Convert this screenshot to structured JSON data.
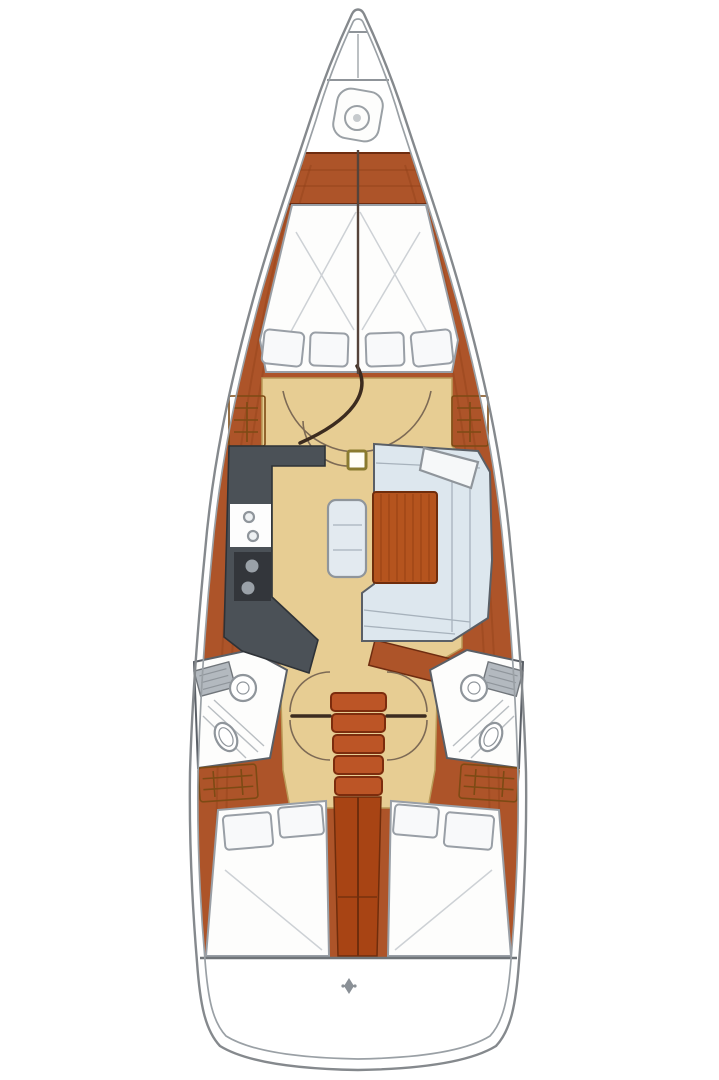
{
  "diagram": {
    "kind": "sailboat-interior-floor-plan",
    "orientation": "bow-up",
    "areas": {
      "bow": [
        "anchor-windlass"
      ],
      "forward_cabin": [
        "v-berth",
        "berth-center-split",
        "pillows-x4",
        "hanging-locker-port",
        "hanging-locker-starboard",
        "cabin-door-swing"
      ],
      "galley_port": [
        "counter",
        "double-sink",
        "two-burner-stove"
      ],
      "salon_starboard": [
        "u-shaped-settee",
        "wood-table",
        "center-bench",
        "corner-shelf",
        "mast-step"
      ],
      "heads": [
        "port-head-with-toilet-sink-shower",
        "starboard-head-with-toilet-sink-shower"
      ],
      "companionway": [
        "five-step-ladder",
        "engine-compartment"
      ],
      "aft_cabins": [
        "port-double-berth-2-pillows",
        "starboard-double-berth-2-pillows",
        "aft-locker-port",
        "aft-locker-starboard"
      ],
      "stern": [
        "cockpit-sole-line",
        "transom-marker"
      ]
    },
    "pillow_count_forward": 4,
    "pillow_count_aft_per_cabin": 2,
    "ladder_steps": 5
  },
  "colors": {
    "hull_fill": "#ffffff",
    "wood": "#ad5429",
    "floor": "#e7cd93",
    "counter": "#4b5157",
    "stove": "#33363b",
    "burner": "#9aa1a8",
    "sink_white": "#fdfdfd",
    "upholstery": "#dde7ee",
    "bench": "#e3eaf0",
    "table": "#b5541e",
    "ladder": "#bc5526",
    "engine": "#a84414",
    "locker": "#d9a155",
    "bed": "#fdfdfc",
    "pillow": "#f8f9fa",
    "head_floor": "#fdfdfc",
    "shelf_white": "#f6f8f9",
    "tank_gray": "#b3b9bf",
    "transom_icon": "#8a9096",
    "mast_step_edge": "#8a7a30"
  }
}
